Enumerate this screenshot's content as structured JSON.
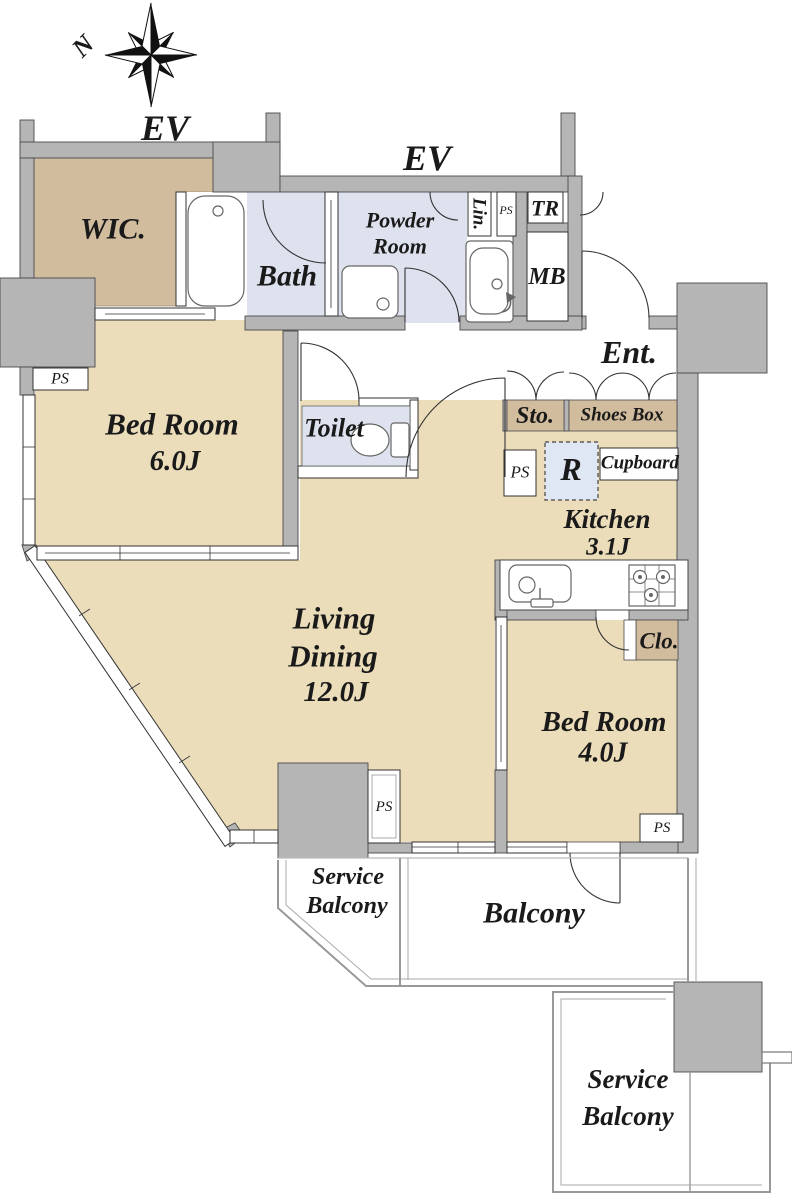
{
  "title": "Apartment floor plan",
  "compass": {
    "north": "N"
  },
  "elevators": {
    "ev1": "EV",
    "ev2": "EV"
  },
  "colors": {
    "wall_gray": "#b5b5b5",
    "room_beige": "#ebdcba",
    "closet_tan": "#d2bc9e",
    "wet_room_blue": "#dde2ee",
    "fridge_blue": "#dfe6f4",
    "outline": "#4a4a4a"
  },
  "rooms": {
    "wic": "WIC.",
    "bath": "Bath",
    "powder_line1": "Powder",
    "powder_line2": "Room",
    "linen": "Lin.",
    "ps_linen": "PS",
    "trunk": "TR",
    "meter_box": "MB",
    "entrance": "Ent.",
    "storage": "Sto.",
    "shoes_box": "Shoes Box",
    "ps_kitchen": "PS",
    "refrigerator": "R",
    "cupboard": "Cupboard",
    "kitchen_name": "Kitchen",
    "kitchen_size": "3.1J",
    "toilet": "Toilet",
    "bedroom6_name": "Bed Room",
    "bedroom6_size": "6.0J",
    "living_line1": "Living",
    "living_line2": "Dining",
    "living_size": "12.0J",
    "closet": "Clo.",
    "bedroom4_name": "Bed Room",
    "bedroom4_size": "4.0J",
    "ps_left": "PS",
    "ps_middle": "PS",
    "ps_bedroom4": "PS",
    "service_balcony_left_line1": "Service",
    "service_balcony_left_line2": "Balcony",
    "balcony": "Balcony",
    "service_balcony_right_line1": "Service",
    "service_balcony_right_line2": "Balcony"
  }
}
